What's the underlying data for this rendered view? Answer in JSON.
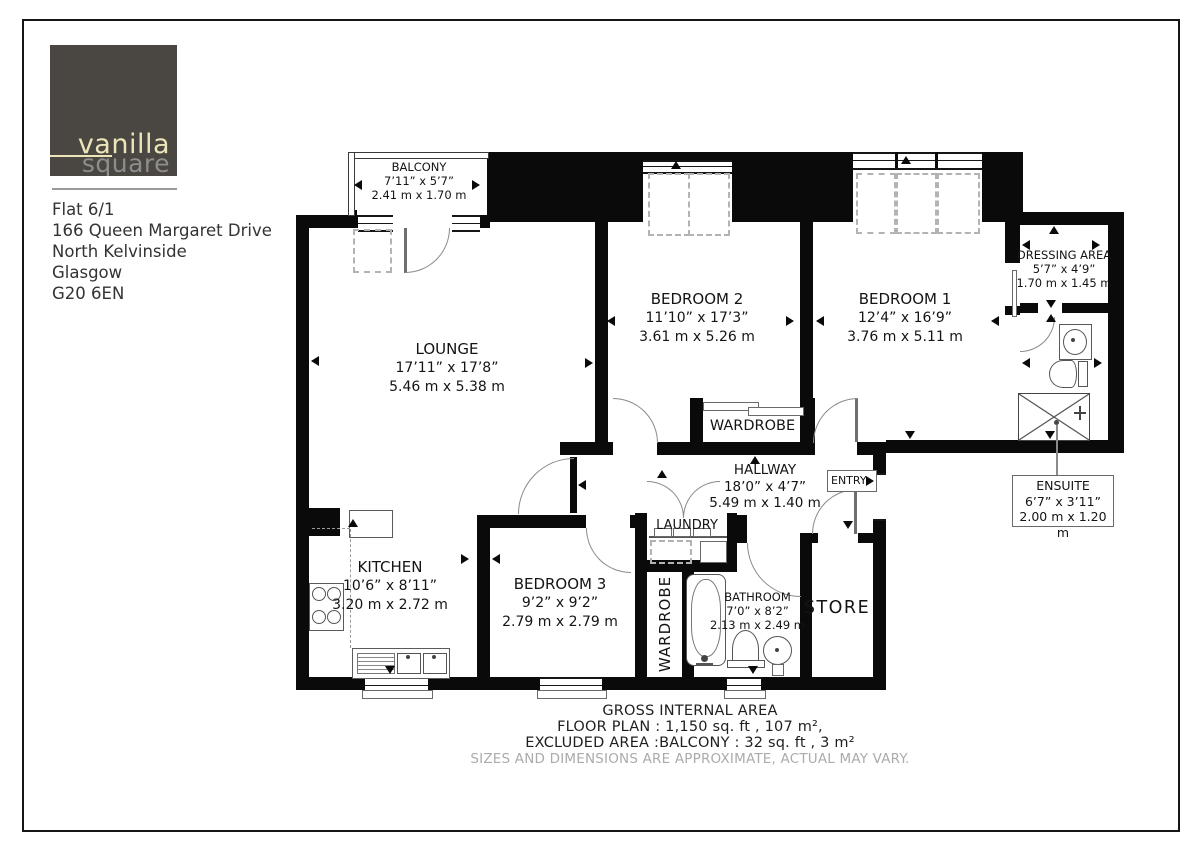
{
  "branding": {
    "logo_primary": "vanilla",
    "logo_secondary": "square"
  },
  "address": {
    "lines": [
      "Flat 6/1",
      "166 Queen Margaret Drive",
      "North Kelvinside",
      "Glasgow",
      "G20 6EN"
    ]
  },
  "rooms": {
    "balcony": {
      "name": "BALCONY",
      "imperial": "7’11” x 5’7”",
      "metric": "2.41 m x 1.70 m"
    },
    "lounge": {
      "name": "LOUNGE",
      "imperial": "17’11” x 17’8”",
      "metric": "5.46 m x 5.38 m"
    },
    "bedroom2": {
      "name": "BEDROOM 2",
      "imperial": "11’10” x 17’3”",
      "metric": "3.61 m x 5.26 m"
    },
    "bedroom1": {
      "name": "BEDROOM 1",
      "imperial": "12’4” x 16’9”",
      "metric": "3.76 m x 5.11 m"
    },
    "dressing": {
      "name": "DRESSING AREA",
      "imperial": "5’7” x 4’9”",
      "metric": "1.70 m x 1.45 m"
    },
    "kitchen": {
      "name": "KITCHEN",
      "imperial": "10’6” x 8’11”",
      "metric": "3.20 m x 2.72 m"
    },
    "bedroom3": {
      "name": "BEDROOM 3",
      "imperial": "9’2” x 9’2”",
      "metric": "2.79 m x 2.79 m"
    },
    "bathroom": {
      "name": "BATHROOM",
      "imperial": "7’0” x 8’2”",
      "metric": "2.13 m x 2.49 m"
    },
    "hallway": {
      "name": "HALLWAY",
      "imperial": "18’0” x 4’7”",
      "metric": "5.49 m x 1.40 m"
    },
    "ensuite": {
      "name": "ENSUITE",
      "imperial": "6’7” x 3’11”",
      "metric": "2.00 m x 1.20 m"
    },
    "wardrobe_bed2": {
      "name": "WARDROBE"
    },
    "wardrobe_bed3": {
      "name": "WARDROBE"
    },
    "laundry": {
      "name": "LAUNDRY"
    },
    "store": {
      "name": "STORE"
    },
    "entry": {
      "name": "ENTRY"
    }
  },
  "footer": {
    "title": "GROSS INTERNAL AREA",
    "line1": "FLOOR PLAN : 1,150 sq. ft , 107 m²,",
    "line2": "EXCLUDED AREA :BALCONY : 32 sq. ft , 3 m²",
    "disclaimer": "SIZES AND DIMENSIONS ARE APPROXIMATE, ACTUAL MAY VARY."
  },
  "colors": {
    "wall": "#0a0a0a",
    "logo_bg": "#4a4742",
    "logo_cream": "#ece5b9",
    "logo_grey": "#8d8d8d",
    "disclaimer_grey": "#ababab"
  }
}
